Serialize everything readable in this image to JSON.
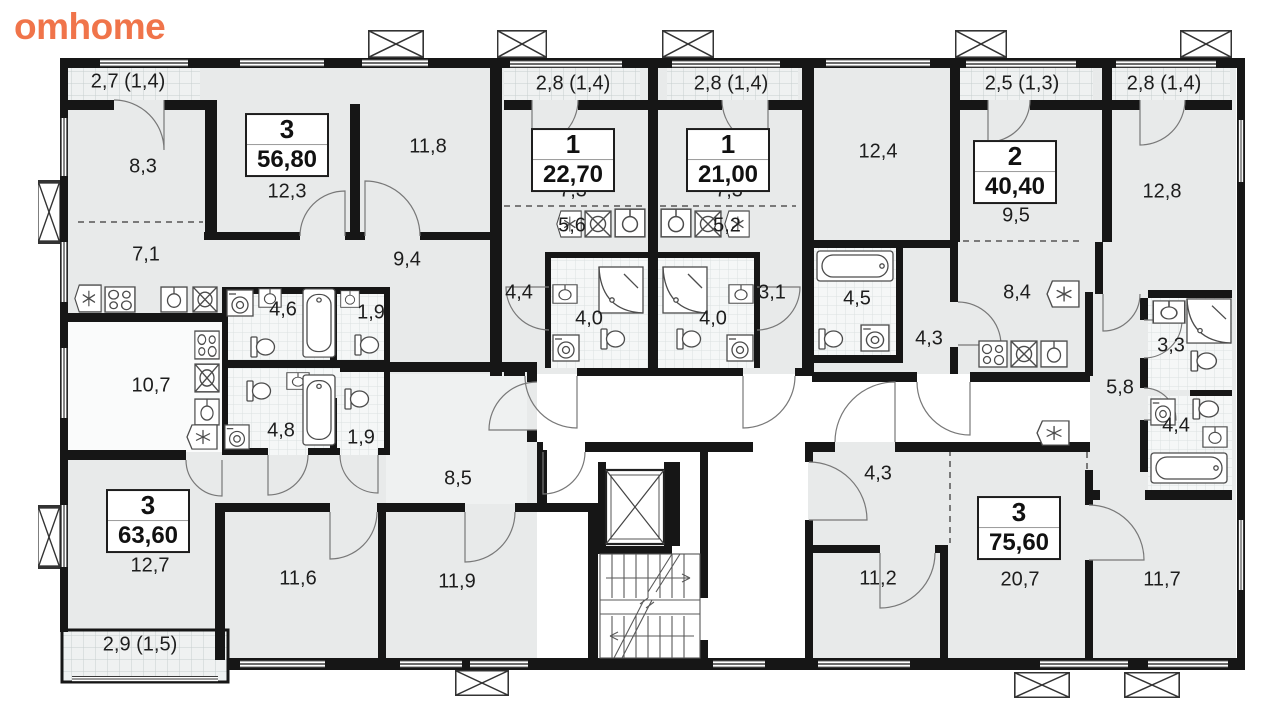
{
  "logo": {
    "text": "omhome",
    "color": "#f0744a"
  },
  "plan": {
    "wall_color": "#161616",
    "room_fill": "#e8eaea",
    "corridor_fill": "#ffffff",
    "apartments": [
      {
        "rooms": "3",
        "area": "56,80",
        "x": 287,
        "y": 145
      },
      {
        "rooms": "1",
        "area": "22,70",
        "x": 573,
        "y": 160
      },
      {
        "rooms": "1",
        "area": "21,00",
        "x": 728,
        "y": 160
      },
      {
        "rooms": "2",
        "area": "40,40",
        "x": 1015,
        "y": 172
      },
      {
        "rooms": "3",
        "area": "63,60",
        "x": 148,
        "y": 521
      },
      {
        "rooms": "3",
        "area": "75,60",
        "x": 1019,
        "y": 528
      }
    ],
    "room_labels": [
      {
        "text": "2,7 (1,4)",
        "x": 128,
        "y": 82
      },
      {
        "text": "8,3",
        "x": 143,
        "y": 167
      },
      {
        "text": "12,3",
        "x": 287,
        "y": 192
      },
      {
        "text": "11,8",
        "x": 428,
        "y": 147
      },
      {
        "text": "2,8 (1,4)",
        "x": 573,
        "y": 84
      },
      {
        "text": "7,3",
        "x": 573,
        "y": 191
      },
      {
        "text": "5,6",
        "x": 572,
        "y": 226
      },
      {
        "text": "2,8 (1,4)",
        "x": 731,
        "y": 84
      },
      {
        "text": "7,3",
        "x": 729,
        "y": 191
      },
      {
        "text": "5,2",
        "x": 727,
        "y": 226
      },
      {
        "text": "12,4",
        "x": 878,
        "y": 152
      },
      {
        "text": "2,5 (1,3)",
        "x": 1022,
        "y": 84
      },
      {
        "text": "9,5",
        "x": 1016,
        "y": 216
      },
      {
        "text": "2,8 (1,4)",
        "x": 1164,
        "y": 84
      },
      {
        "text": "12,8",
        "x": 1162,
        "y": 192
      },
      {
        "text": "7,1",
        "x": 146,
        "y": 255
      },
      {
        "text": "9,4",
        "x": 407,
        "y": 260
      },
      {
        "text": "4,6",
        "x": 283,
        "y": 310
      },
      {
        "text": "1,9",
        "x": 371,
        "y": 313
      },
      {
        "text": "10,7",
        "x": 151,
        "y": 386
      },
      {
        "text": "4,8",
        "x": 281,
        "y": 431
      },
      {
        "text": "1,9",
        "x": 361,
        "y": 438
      },
      {
        "text": "4,4",
        "x": 519,
        "y": 293
      },
      {
        "text": "4,0",
        "x": 589,
        "y": 319
      },
      {
        "text": "4,0",
        "x": 713,
        "y": 319
      },
      {
        "text": "3,1",
        "x": 772,
        "y": 293
      },
      {
        "text": "4,5",
        "x": 857,
        "y": 299
      },
      {
        "text": "4,3",
        "x": 929,
        "y": 339
      },
      {
        "text": "8,4",
        "x": 1017,
        "y": 293
      },
      {
        "text": "3,3",
        "x": 1171,
        "y": 346
      },
      {
        "text": "5,8",
        "x": 1120,
        "y": 388
      },
      {
        "text": "4,4",
        "x": 1176,
        "y": 426
      },
      {
        "text": "8,5",
        "x": 458,
        "y": 479
      },
      {
        "text": "12,7",
        "x": 150,
        "y": 566
      },
      {
        "text": "11,6",
        "x": 298,
        "y": 579
      },
      {
        "text": "11,9",
        "x": 457,
        "y": 582
      },
      {
        "text": "2,9 (1,5)",
        "x": 140,
        "y": 645
      },
      {
        "text": "4,3",
        "x": 878,
        "y": 474
      },
      {
        "text": "11,2",
        "x": 878,
        "y": 579
      },
      {
        "text": "20,7",
        "x": 1020,
        "y": 580
      },
      {
        "text": "11,7",
        "x": 1162,
        "y": 580
      }
    ]
  }
}
